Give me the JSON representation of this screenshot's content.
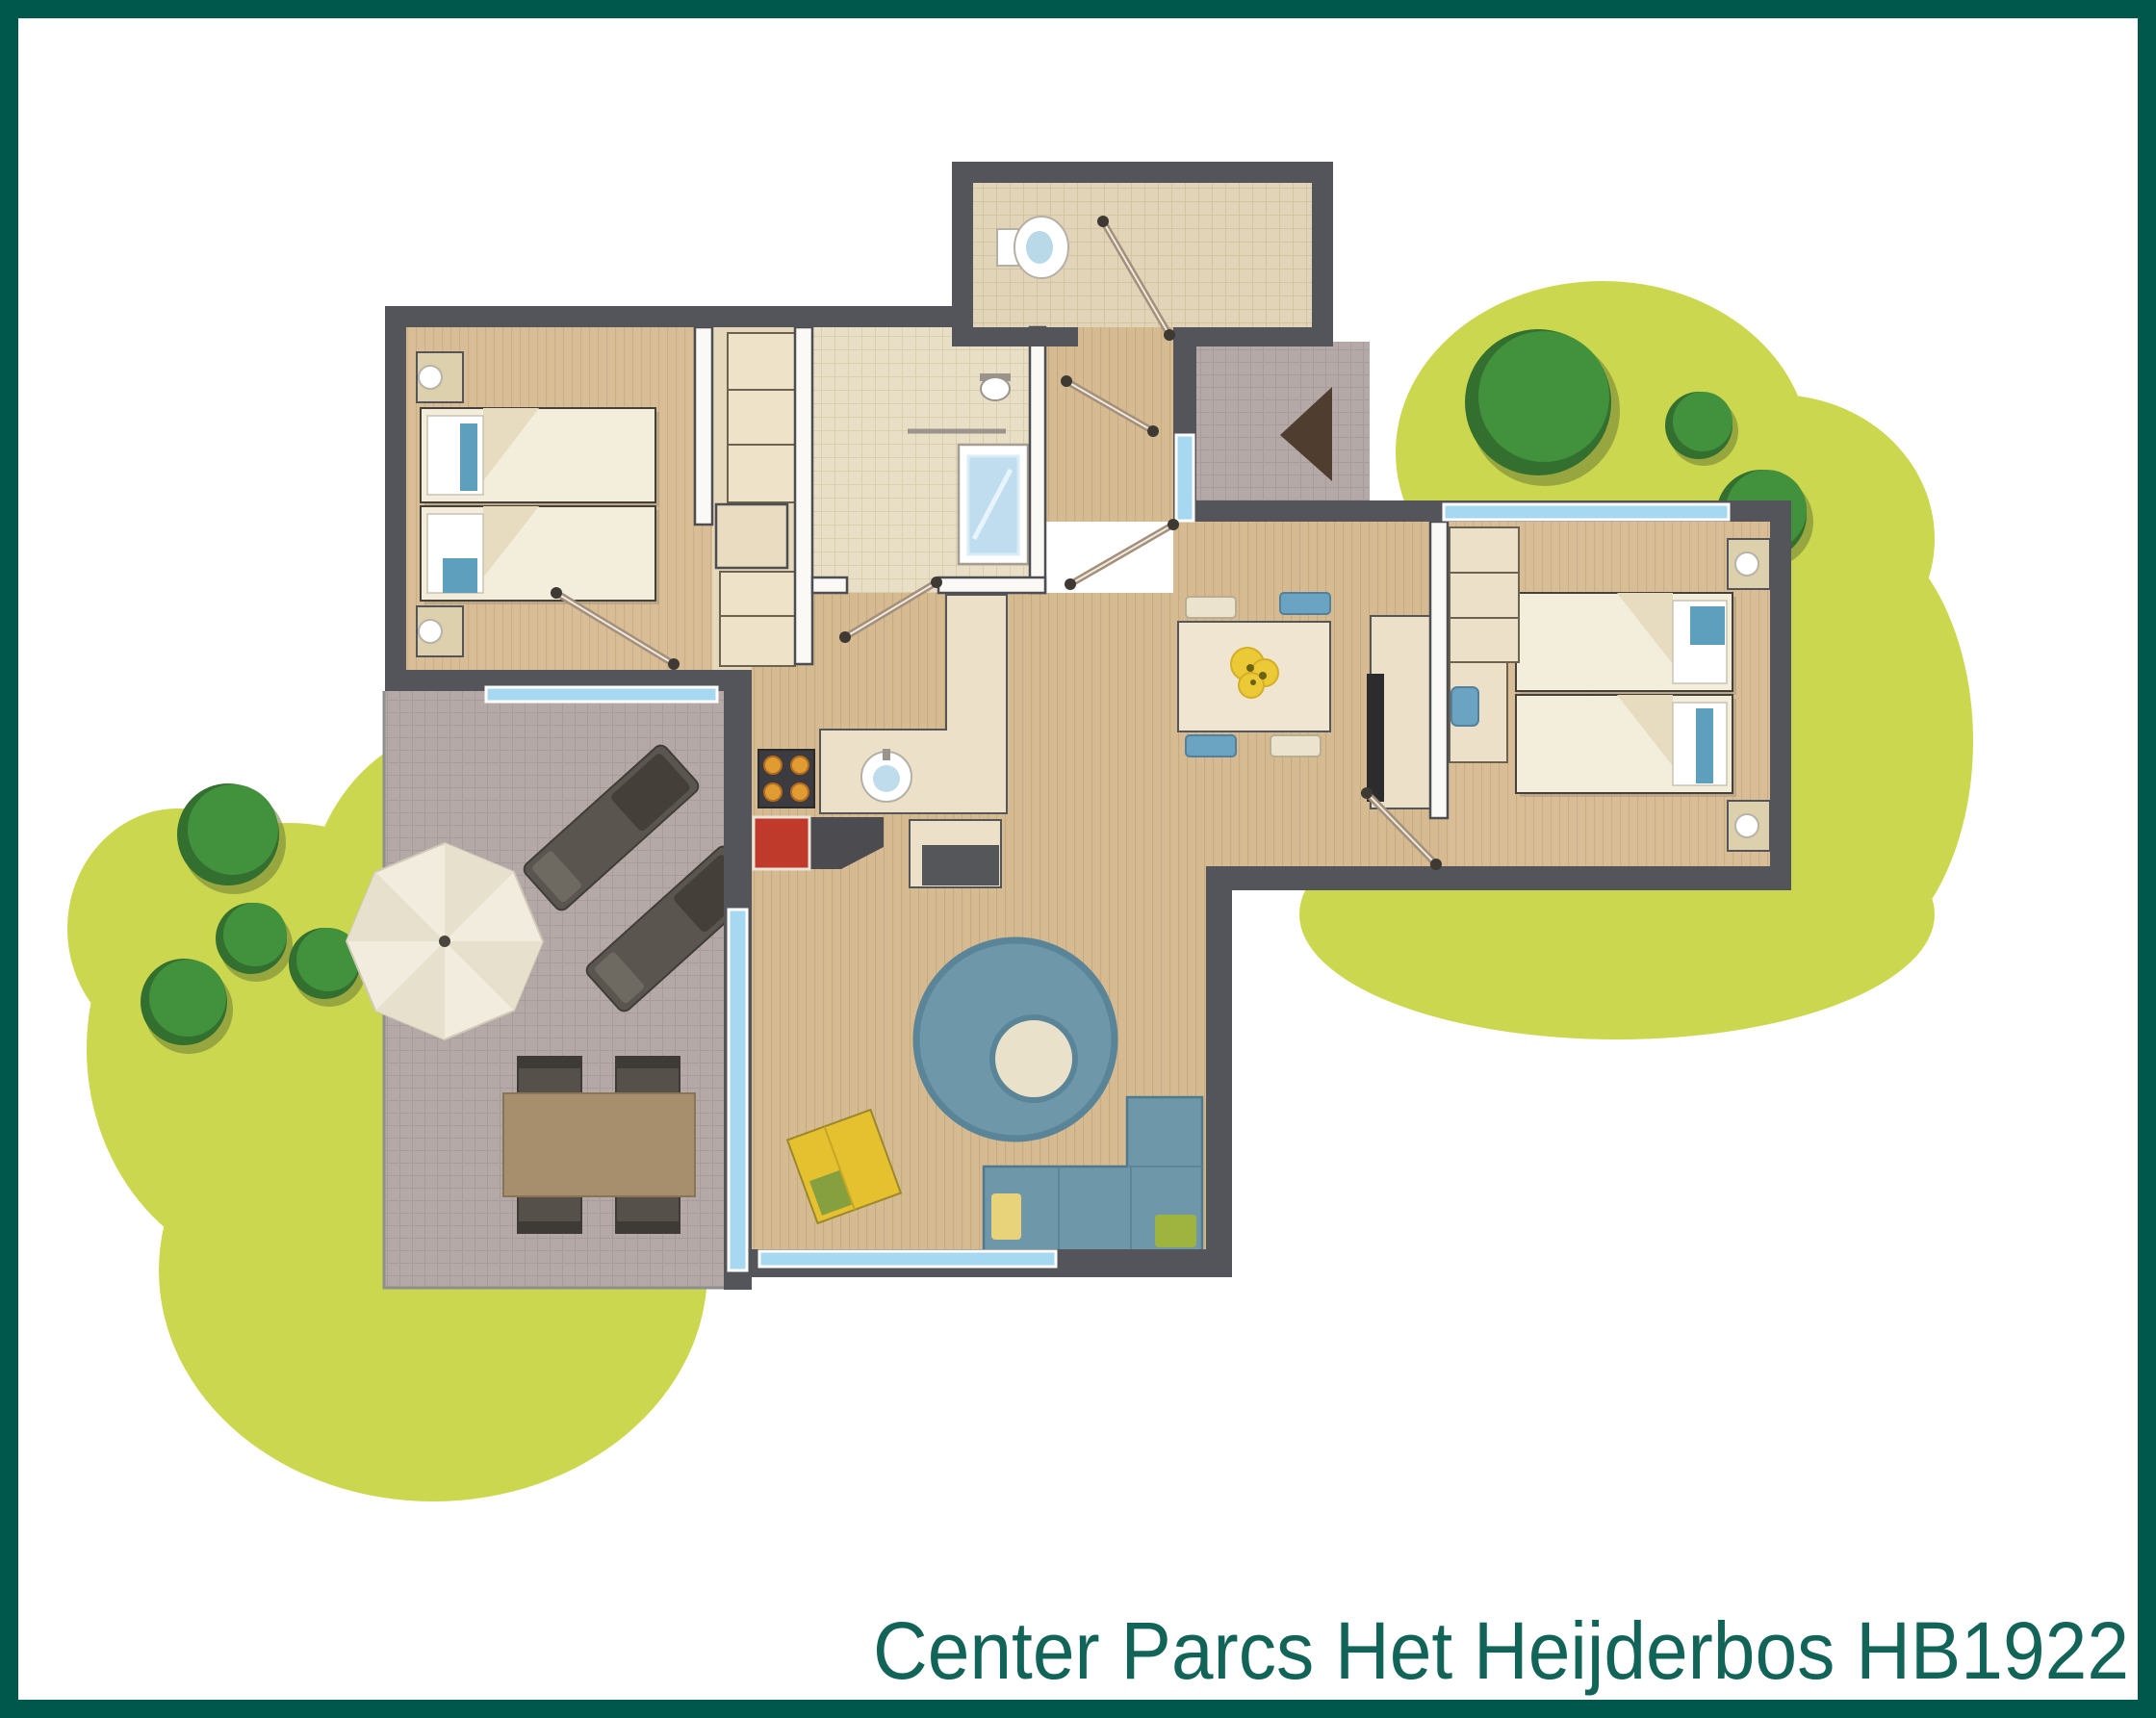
{
  "title": {
    "label": "Center Parcs Het Heijderbos HB1922"
  },
  "frame": {
    "border_color": "#00584d",
    "background_color": "#ffffff",
    "title_color": "#116457"
  },
  "palette": {
    "wall": "#54555a",
    "interior_partition": "#faf9f6",
    "wood_floor": "#d5ba92",
    "bathroom_tile": "#e9dec6",
    "terrace": "#b5a9a7",
    "window_glass": "#a7d8f2",
    "grass": "#cbd74f",
    "tree": "#3f8a3a",
    "sofa_rug_blue": "#6e97a9",
    "accent_red_fireplace": "#bf3a2b",
    "accent_yellow_mat": "#e5c12f",
    "bed_linen": "#f3eddb",
    "pillow_blue": "#5f9fbe"
  },
  "floor_plan": {
    "rooms": [
      {
        "name": "bedroom-left",
        "furniture": [
          "2 single beds",
          "2 nightstands with lamps",
          "wardrobe closet"
        ]
      },
      {
        "name": "bedroom-right",
        "furniture": [
          "2 single beds",
          "2 nightstands with lamps",
          "wardrobe",
          "desk with chair"
        ]
      },
      {
        "name": "bathroom",
        "furniture": [
          "shower",
          "washbasin",
          "towel rail"
        ]
      },
      {
        "name": "wc",
        "furniture": [
          "toilet"
        ]
      },
      {
        "name": "hall-entrance",
        "furniture": [
          "entrance mat"
        ]
      },
      {
        "name": "kitchen",
        "furniture": [
          "hob",
          "sink",
          "fireplace",
          "counter",
          "bar cabinet"
        ]
      },
      {
        "name": "living-dining",
        "furniture": [
          "dining table",
          "4 dining chairs",
          "corner sofa with cushions",
          "round rug",
          "pouf",
          "tv cabinet",
          "play mat"
        ]
      },
      {
        "name": "terrace",
        "furniture": [
          "parasol",
          "2 sun loungers",
          "outdoor dining table",
          "4 outdoor chairs"
        ]
      },
      {
        "name": "garden",
        "furniture": [
          "grass areas",
          "7 trees"
        ]
      }
    ],
    "window_count": 5,
    "door_count": 6
  }
}
